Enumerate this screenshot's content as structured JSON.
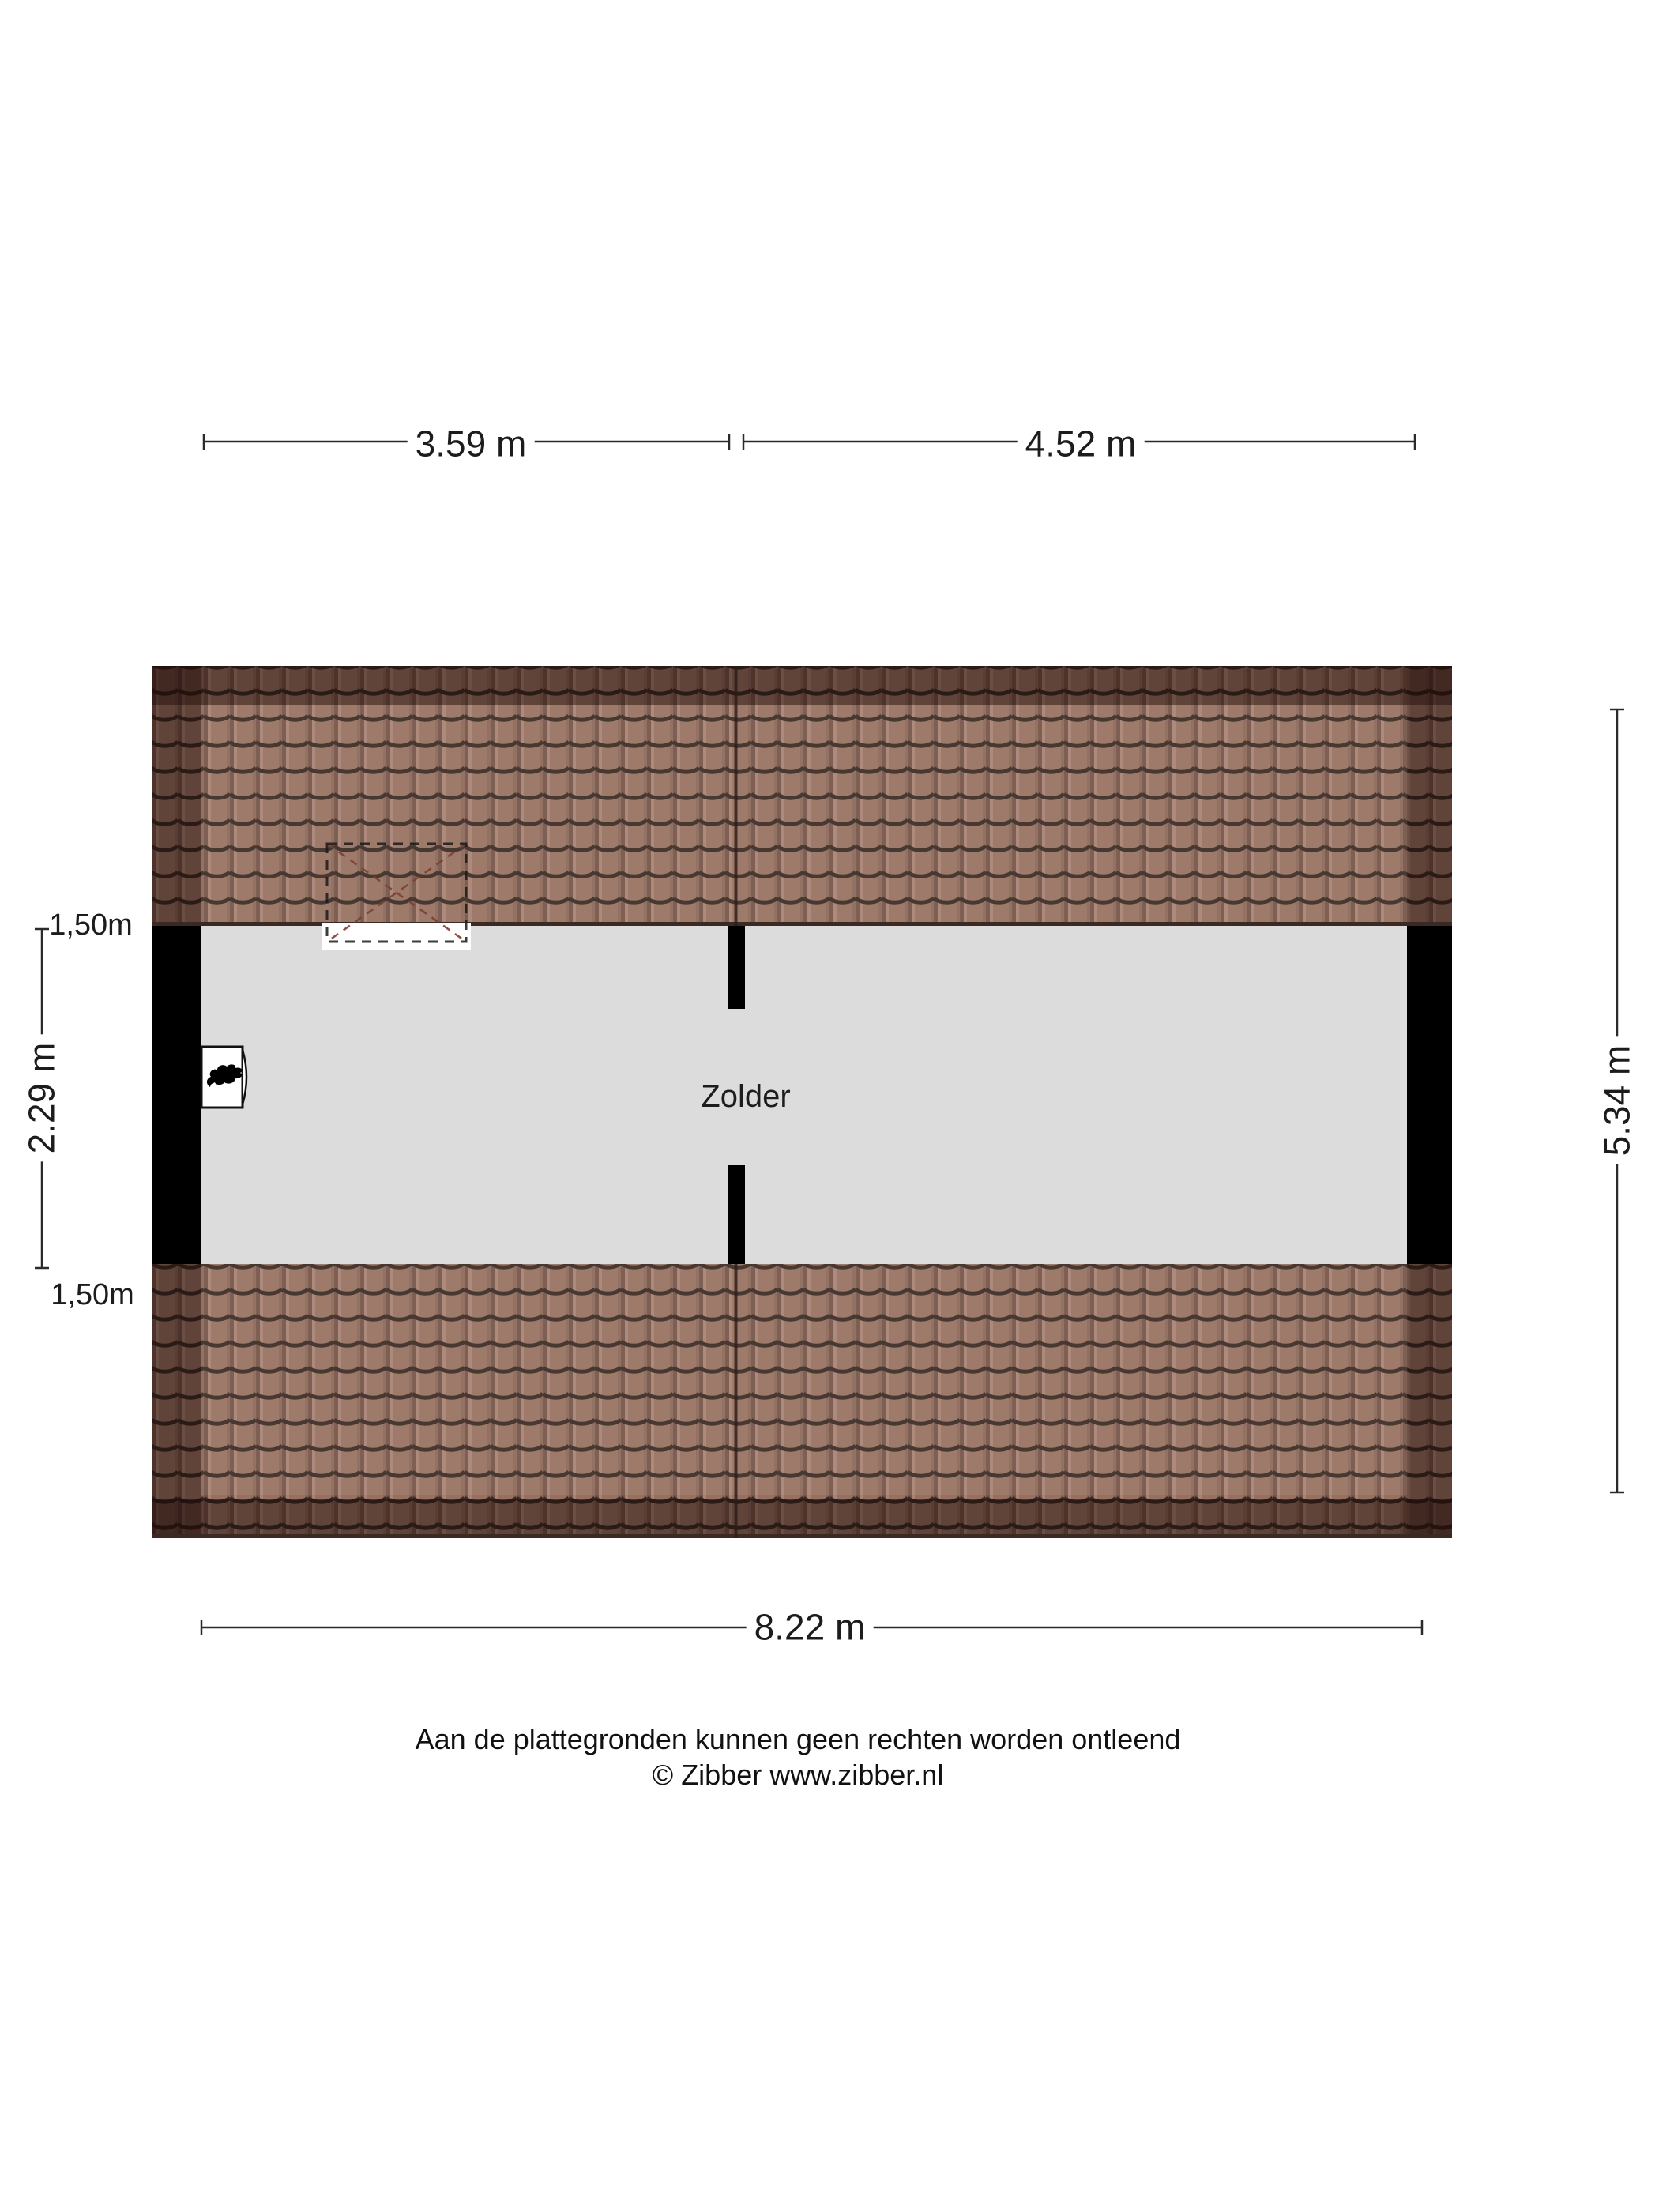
{
  "floorplan": {
    "room": {
      "label": "Zolder"
    },
    "dimensions": {
      "top_left": "3.59 m",
      "top_right": "4.52 m",
      "bottom": "8.22 m",
      "right": "5.34 m",
      "left": "2.29 m",
      "knee_height_top": "1,50m",
      "knee_height_bottom": "1,50m"
    },
    "colors": {
      "tile": "#97705f",
      "tile_line": "#3a2a23",
      "floor": "#dcdcdc",
      "wall": "#000000"
    }
  },
  "footer": {
    "disclaimer": "Aan de plattegronden kunnen geen rechten worden ontleend",
    "copyright": "© Zibber www.zibber.nl"
  }
}
